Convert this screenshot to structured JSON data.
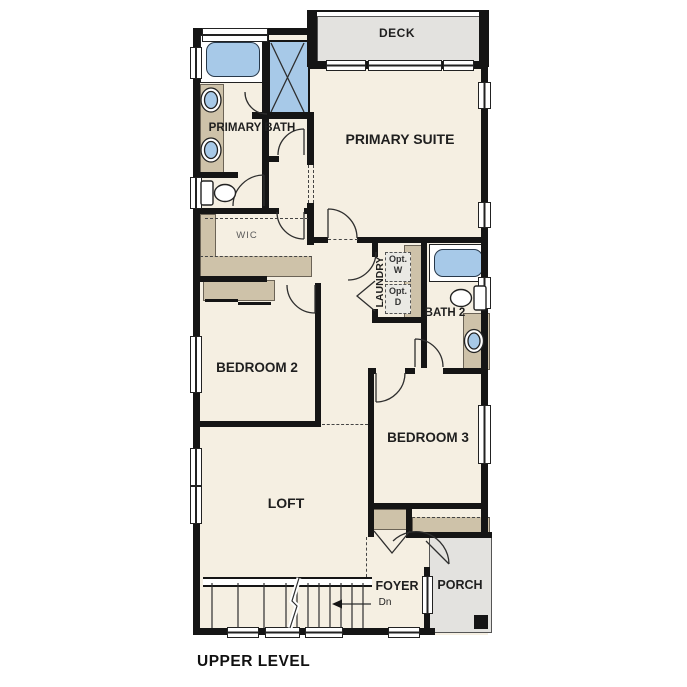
{
  "title": "UPPER LEVEL",
  "rooms": {
    "deck": "DECK",
    "primary_suite": "PRIMARY SUITE",
    "primary_bath": "PRIMARY BATH",
    "wic": "WIC",
    "laundry": "LAUNDRY",
    "bath_2": "BATH 2",
    "bedroom_2": "BEDROOM 2",
    "bedroom_3": "BEDROOM 3",
    "loft": "LOFT",
    "foyer": "FOYER",
    "porch": "PORCH"
  },
  "annotations": {
    "opt_washer": "Opt. W",
    "opt_dryer": "Opt. D",
    "stairs_down": "Dn"
  },
  "colors": {
    "wall": "#151515",
    "floor": "#f5efe2",
    "fixture_blue": "#a7c9e8",
    "counter_tan": "#cec2a9",
    "deck_gray": "#e3e2df"
  }
}
